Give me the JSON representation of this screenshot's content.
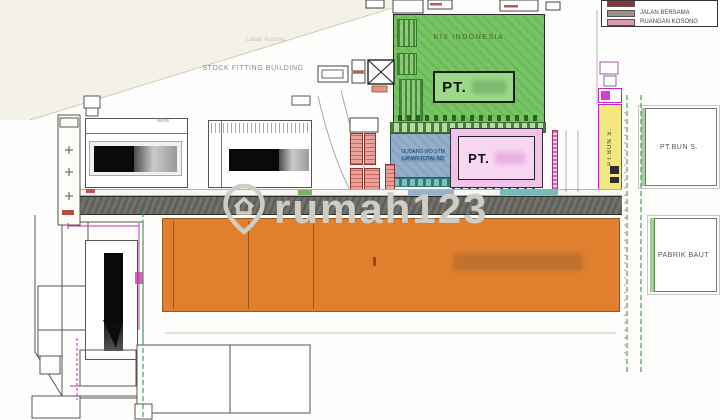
{
  "watermark": {
    "text": "rumah123"
  },
  "legend": {
    "items": [
      {
        "label": "",
        "swatch": "#8c2f39"
      },
      {
        "label": "JALAN BERSAMA",
        "swatch": "#9b9188"
      },
      {
        "label": "RUANGAN KOSONG",
        "swatch": "#d99cb4"
      }
    ]
  },
  "labels": {
    "lahan_kosong": "Lahan Kosong",
    "stock_fitting_building": "STOCK FITTING BUILDING",
    "ki3_indonesia": "KI3 INDONESIA",
    "pt_green": "PT.",
    "pt_pink": "PT.",
    "gudang_line1": "GUDANG WD STM",
    "gudang_line2": "LAHAN TOTAL M2",
    "pt_bun_vertical": "PT.BUN S.",
    "pt_bun_right": "PT.BUN S.",
    "pabrik_baut": "PABRIK BAUT",
    "mess": "Mess"
  },
  "colors": {
    "green_block": "#6fbf5f",
    "pink_block": "#f3c2ea",
    "blue_block": "#8fabc9",
    "orange_block": "#e0802f",
    "yellow_block": "#f2e87d",
    "salmon_block": "#e9a29a",
    "road": "#66665f",
    "magenta_lines": "#cc33aa",
    "boundary_dash_green": "#3aa060",
    "watermark_gray": "#cfccc6"
  }
}
